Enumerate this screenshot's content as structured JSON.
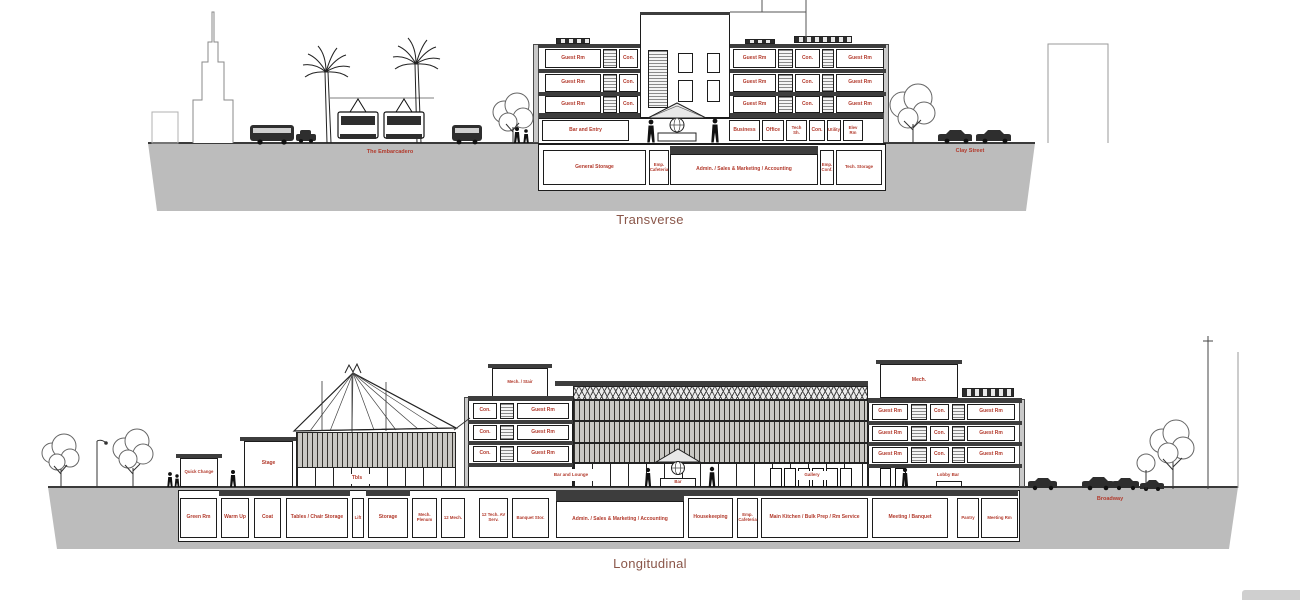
{
  "colors": {
    "label_red": "#b23a2c",
    "title_maroon": "#8a5649",
    "ground_gray": "#bcbcbc"
  },
  "shared": {
    "guest_rm": "Guest Rm",
    "con": "Con.",
    "bar": "Bar"
  },
  "transverse": {
    "title": "Transverse",
    "street_left": "The Embarcadero",
    "street_right": "Clay Street",
    "ground_rooms": {
      "entry": "Bar and Entry",
      "business": "Business",
      "office": "Office",
      "tech_sh": "Tech Sh.",
      "con": "Con.",
      "utility": "Utility",
      "elev_rm": "Elev Rm"
    },
    "basement_rooms": {
      "general_storage": "General Storage",
      "emp_cafeteria": "Emp. Cafeteria",
      "admin": "Admin. / Sales & Marketing / Accounting",
      "emp_conf": "Emp. Conf.",
      "tech_storage": "Tech. Storage"
    }
  },
  "longitudinal": {
    "title": "Longitudinal",
    "street_right": "Broadway",
    "pavilion": {
      "quick_change": "Quick Change",
      "stage": "Stage",
      "tbls": "Tbls"
    },
    "towers": {
      "mech_stair": "Mech. / Stair",
      "mech": "Mech."
    },
    "ground_rooms": {
      "bar_lounge": "Bar and Lounge",
      "bar": "Bar",
      "gallery": "Gallery",
      "lobby_bar": "Lobby Bar"
    },
    "basement_rooms": {
      "green_rm": "Green Rm",
      "warm_up": "Warm Up",
      "coat": "Coat",
      "tables_chair": "Tables / Chair Storage",
      "lift": "Lift",
      "storage": "Storage",
      "mech_plenum": "Mech. Plenum",
      "mech_12": "12 Mech.",
      "tech_av": "12 Tech. AV Serv.",
      "banquet_stor": "Banquet Stor.",
      "admin": "Admin. / Sales & Marketing / Accounting",
      "housekeeping": "Housekeeping",
      "emp_cafeteria": "Emp. Cafeteria",
      "main_kitchen": "Main Kitchen / Bulk Prep / Rm Service",
      "meeting_banquet": "Meeting / Banquet",
      "pantry": "Pantry",
      "meeting_rm": "Meeting Rm"
    }
  }
}
